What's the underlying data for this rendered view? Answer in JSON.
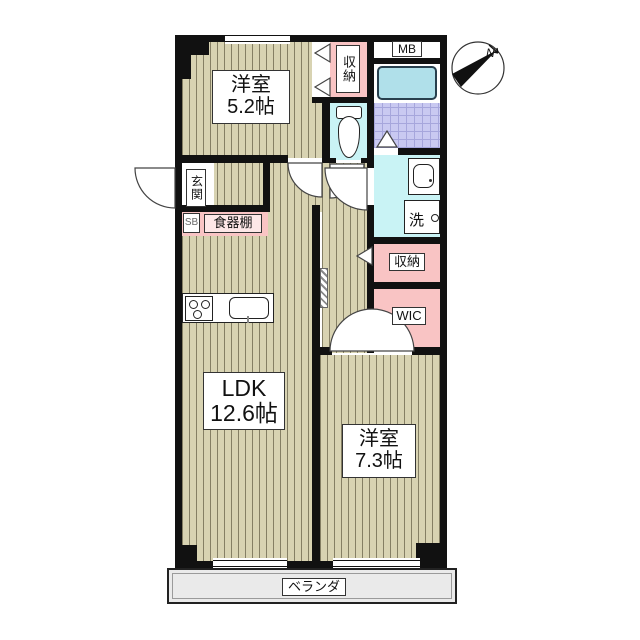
{
  "floorplan": {
    "compass": {
      "label": "N"
    },
    "rooms": {
      "bedroom1": {
        "name": "洋室",
        "size": "5.2帖"
      },
      "ldk": {
        "name": "LDK",
        "size": "12.6帖"
      },
      "bedroom2": {
        "name": "洋室",
        "size": "7.3帖"
      }
    },
    "areas": {
      "entrance": "玄関",
      "closet_top": "収納",
      "closet_mid": "収納",
      "wic": "WIC",
      "meter_box": "MB",
      "laundry": "洗",
      "shoe_box": "SB",
      "cupboard": "食器棚",
      "veranda": "ベランダ"
    },
    "colors": {
      "wall": "#111111",
      "floor_wood": "#d8d3b2",
      "storage_pink": "#f9c4c4",
      "wet_area_cyan": "#c9f3f5",
      "tile_lavender": "#c9c9f1",
      "bathtub": "#b0e0ea",
      "veranda_gray": "#eaeaea"
    }
  }
}
